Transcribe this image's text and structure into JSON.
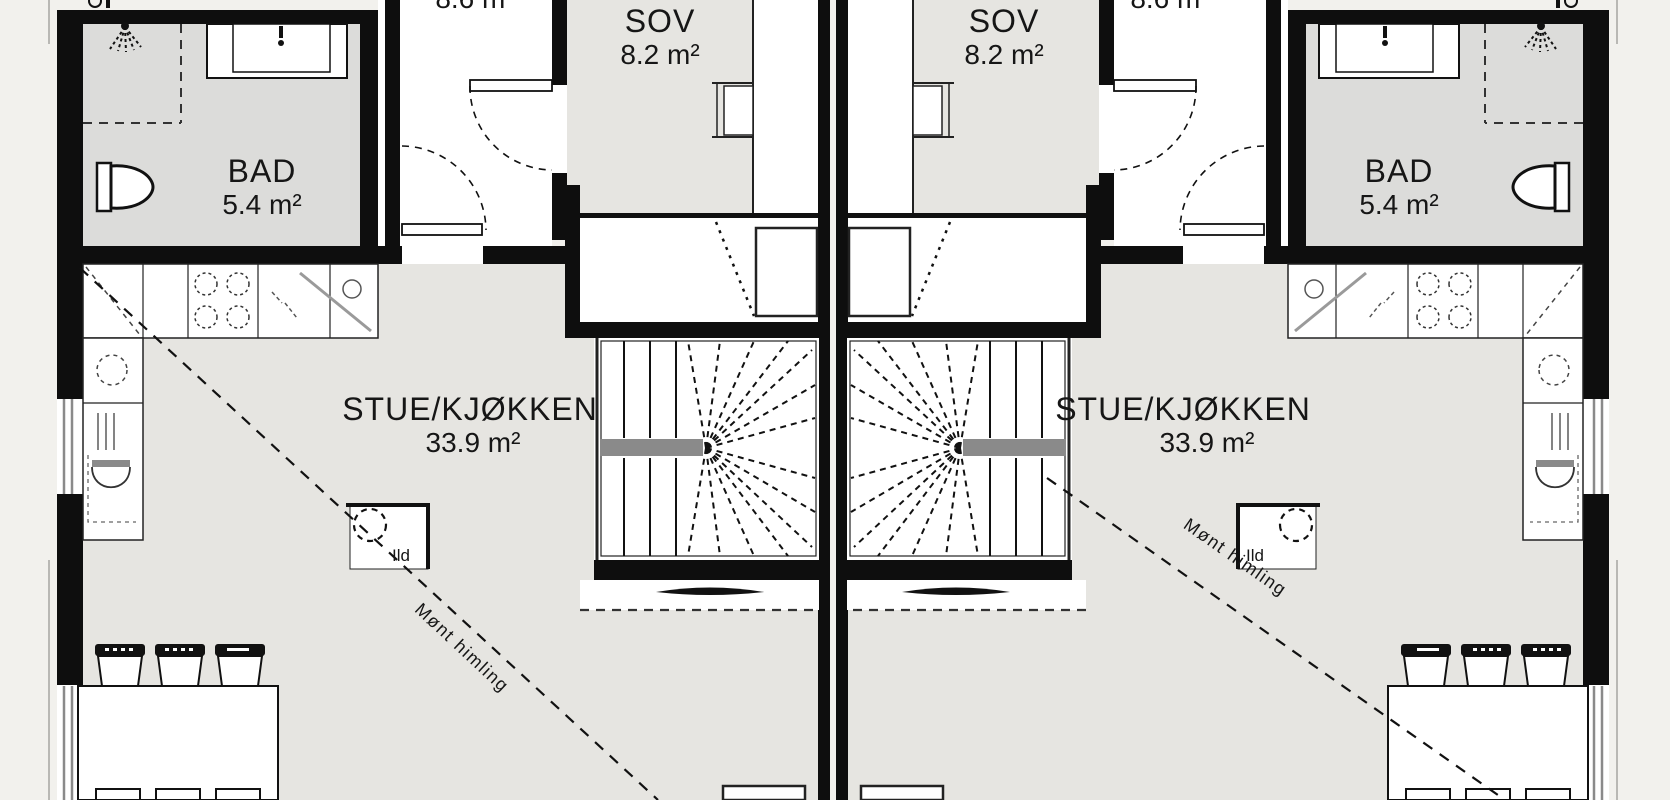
{
  "plan": {
    "type": "architectural-floor-plan",
    "style": "mirrored duplex, one shared party wall, plan cropped at top and bottom",
    "rooms": {
      "bad": {
        "name": "BAD",
        "area": "5.4 m²"
      },
      "sov": {
        "name": "SOV",
        "area": "8.2 m²"
      },
      "stue": {
        "name": "STUE/KJØKKEN",
        "area": "33.9 m²"
      },
      "hall": {
        "area": "8.6 m²"
      }
    },
    "annotations": {
      "fireplace": "Ild",
      "ceiling": "Mønt himling"
    },
    "colors": {
      "background": "#f2f1ed",
      "floor": "#e6e5e1",
      "bath_floor": "#dcdcda",
      "white_room": "#ffffff",
      "wall": "#0e0e0e",
      "stair_landing": "#8a8a8a"
    }
  }
}
